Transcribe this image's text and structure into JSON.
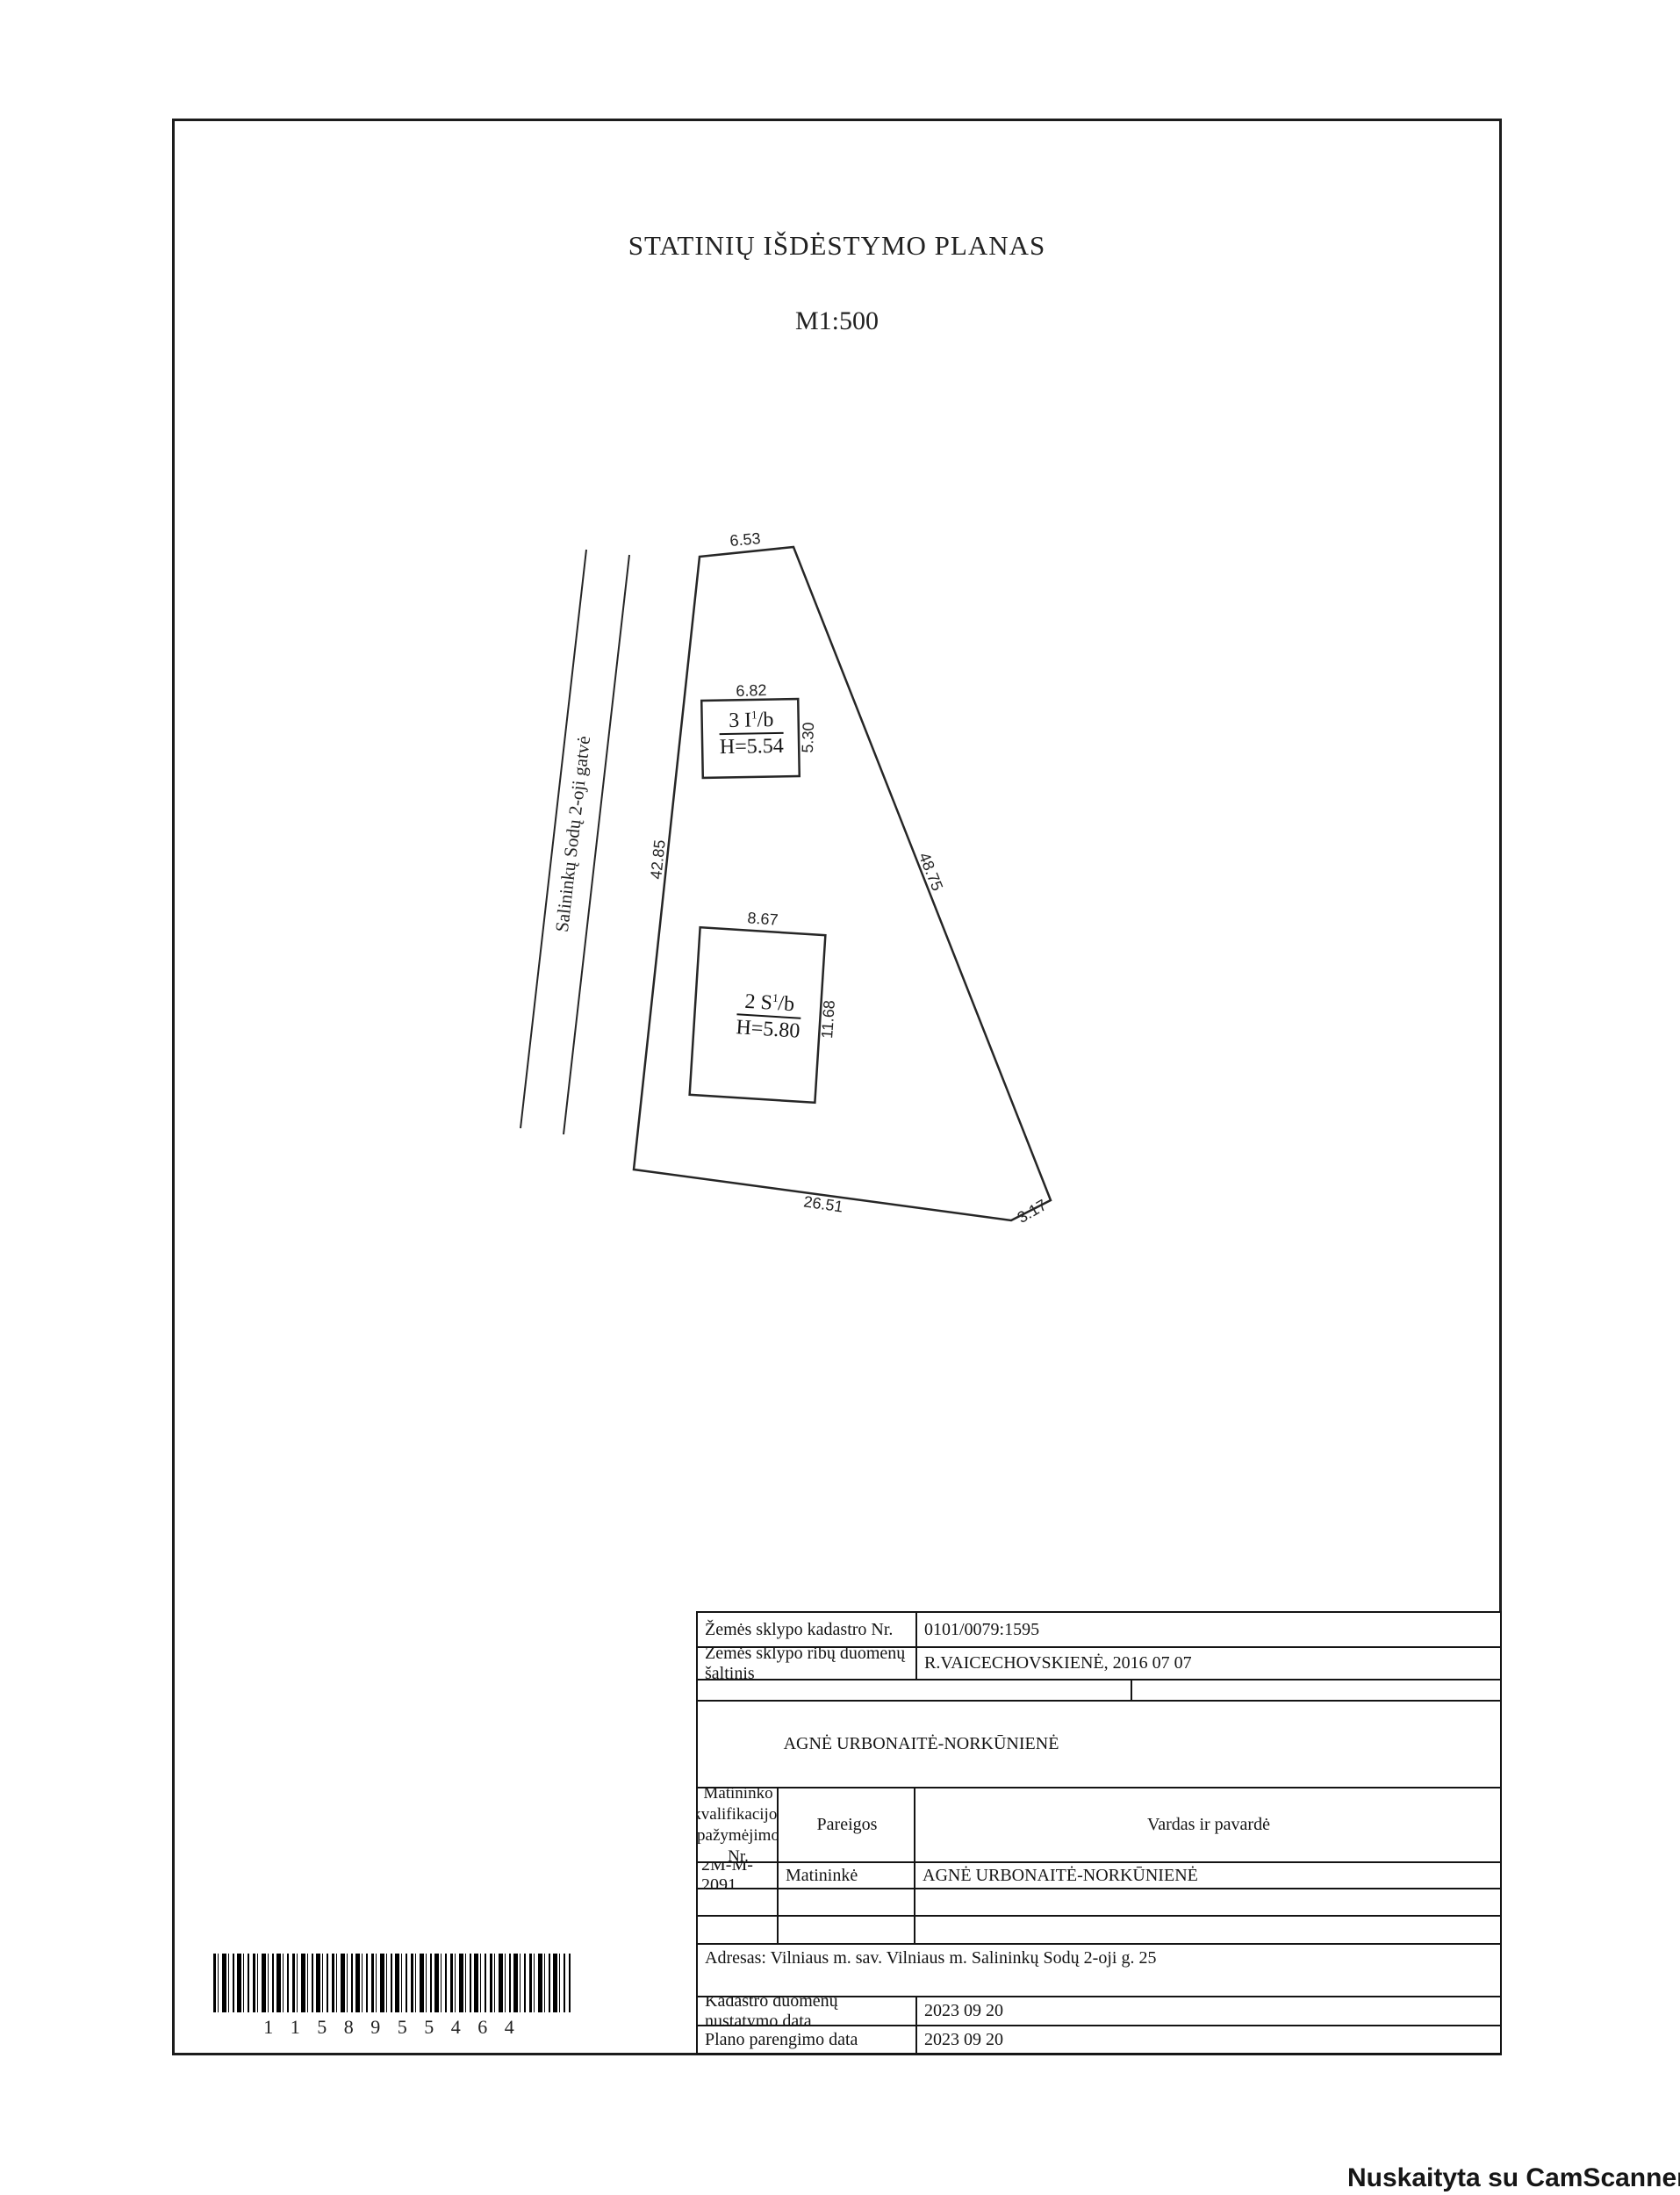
{
  "title": "STATINIŲ IŠDĖSTYMO PLANAS",
  "scale": "M1:500",
  "plan": {
    "street_name": "Salininkų Sodų 2-oji gatvė",
    "dims": {
      "top": "6.53",
      "left": "42.85",
      "right": "48.75",
      "bottom": "26.51",
      "bottom_right": "3.17"
    },
    "building1": {
      "code": "3 I",
      "code_sup": "1",
      "code_suffix": "/b",
      "height": "H=5.54",
      "width_dim": "6.82",
      "depth_dim": "5.30"
    },
    "building2": {
      "code": "2 S",
      "code_sup": "1",
      "code_suffix": "/b",
      "height": "H=5.80",
      "width_dim": "8.67",
      "depth_dim": "11.68"
    }
  },
  "table": {
    "kadastro_label": "Žemės sklypo kadastro Nr.",
    "kadastro_value": "0101/0079:1595",
    "saltinis_label": "Žemės sklypo ribų duomenų šaltinis",
    "saltinis_value": "R.VAICECHOVSKIENĖ, 2016 07 07",
    "surveyor_header": "AGNĖ URBONAITĖ-NORKŪNIENĖ",
    "col1_header_l1": "Matininko",
    "col1_header_l2": "kvalifikacijos",
    "col1_header_l3": "pažymėjimo Nr.",
    "col2_header": "Pareigos",
    "col3_header": "Vardas ir pavardė",
    "cert_no": "2M-M-2091",
    "position": "Matininkė",
    "surveyor_name": "AGNĖ URBONAITĖ-NORKŪNIENĖ",
    "address": "Adresas: Vilniaus m. sav. Vilniaus m. Salininkų Sodų 2-oji g. 25",
    "kadastro_date_label": "Kadastro duomenų nustatymo data",
    "kadastro_date_value": "2023 09 20",
    "plano_date_label": "Plano parengimo data",
    "plano_date_value": "2023 09 20"
  },
  "barcode": {
    "digits": "1 1 5 8 9 5 5 4 6 4"
  },
  "watermark": "Nuskaityta su CamScanner"
}
